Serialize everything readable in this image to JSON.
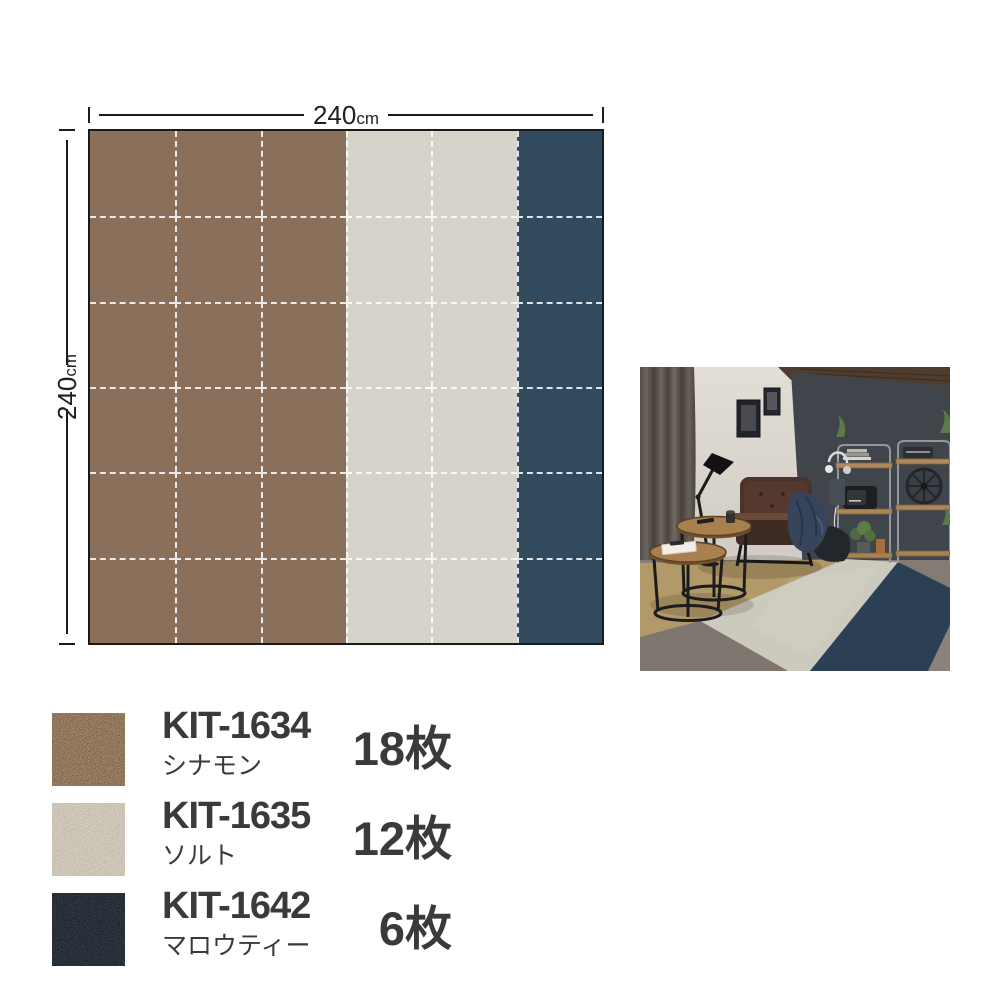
{
  "diagram": {
    "width_label": "240",
    "height_label": "240",
    "unit": "cm",
    "grid": {
      "rows": 6,
      "cols": 6
    },
    "column_colors": [
      "cinnamon",
      "cinnamon",
      "cinnamon",
      "salt",
      "salt",
      "mallow_tea"
    ],
    "palette": {
      "cinnamon": "#8A6F5B",
      "salt": "#D6D3CA",
      "mallow_tea": "#324A5E"
    },
    "grid_line_color": "rgba(255,255,255,0.85)",
    "border_color": "#1A1A1A"
  },
  "legend": {
    "items": [
      {
        "code": "KIT-1634",
        "name": "シナモン",
        "count": "18枚",
        "swatch_color": "#8A6B4E"
      },
      {
        "code": "KIT-1635",
        "name": "ソルト",
        "count": "12枚",
        "swatch_color": "#CBC2B2"
      },
      {
        "code": "KIT-1642",
        "name": "マロウティー",
        "count": "6枚",
        "swatch_color": "#1B2430"
      }
    ]
  },
  "photo": {
    "accent_wall_color": "#40454C",
    "side_wall_color": "#D9D5CC",
    "carpet_tan_color": "#B29968",
    "carpet_gray_color": "#CCCABC",
    "carpet_navy_color": "#2C4055",
    "concrete_color": "#837B74"
  }
}
